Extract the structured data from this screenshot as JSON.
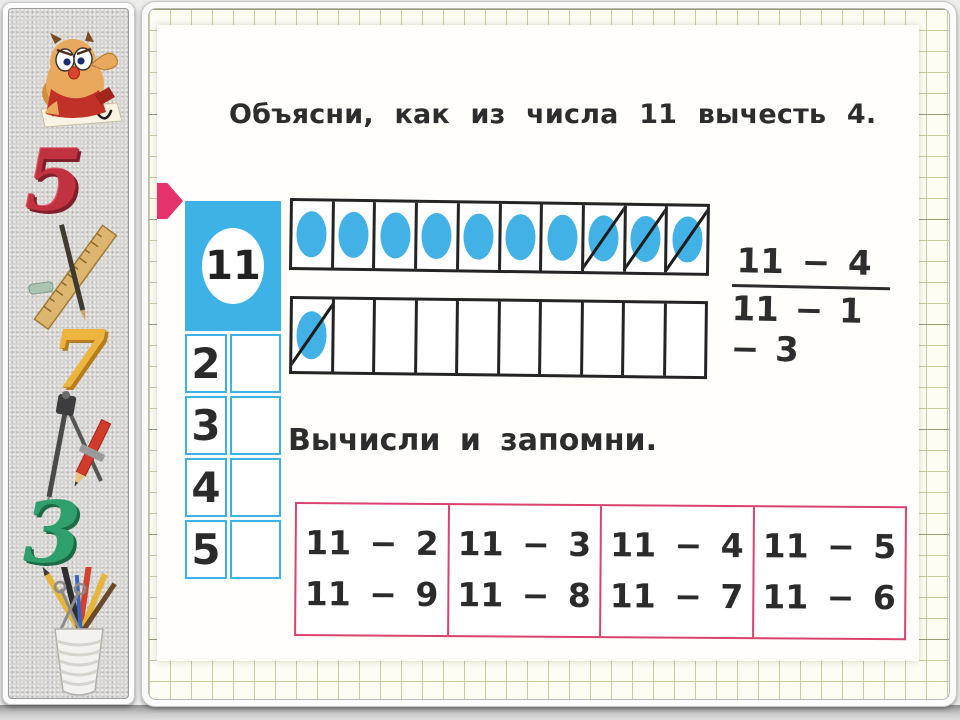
{
  "slide": {
    "title": "Объясни, как из числа 11 вычесть 4.",
    "subtitle": "Вычисли и запомни."
  },
  "number_table": {
    "header": "11",
    "rows": [
      "2",
      "3",
      "4",
      "5"
    ]
  },
  "strips": [
    {
      "cells": [
        "circle",
        "circle",
        "circle",
        "circle",
        "circle",
        "circle",
        "circle",
        "circle-crossed",
        "circle-crossed",
        "circle-crossed"
      ]
    },
    {
      "cells": [
        "circle-crossed",
        "empty",
        "empty",
        "empty",
        "empty",
        "empty",
        "empty",
        "empty",
        "empty",
        "empty"
      ]
    }
  ],
  "equation": {
    "numerator": "11 − 4",
    "denominator": "11 − 1 − 3"
  },
  "memorize_table": {
    "columns": [
      {
        "line1": "11 − 2",
        "line2": "11 − 9"
      },
      {
        "line1": "11 − 3",
        "line2": "11 − 8"
      },
      {
        "line1": "11 − 4",
        "line2": "11 − 7"
      },
      {
        "line1": "11 − 5",
        "line2": "11 − 6"
      }
    ]
  },
  "sidebar": {
    "digit_five": "5",
    "digit_seven": "7",
    "digit_three": "3",
    "decorations": [
      "owl-mascot",
      "digit-five",
      "ruler-and-pencil",
      "digit-seven",
      "drawing-compass",
      "digit-three",
      "pencil-cup"
    ]
  },
  "colors": {
    "accent_blue": "#3db2e7",
    "arrow_pink": "#e5326b",
    "table_border_pink": "#d9436e",
    "grid_line_olive": "#c9cd9c",
    "text": "#2d2d2d"
  }
}
